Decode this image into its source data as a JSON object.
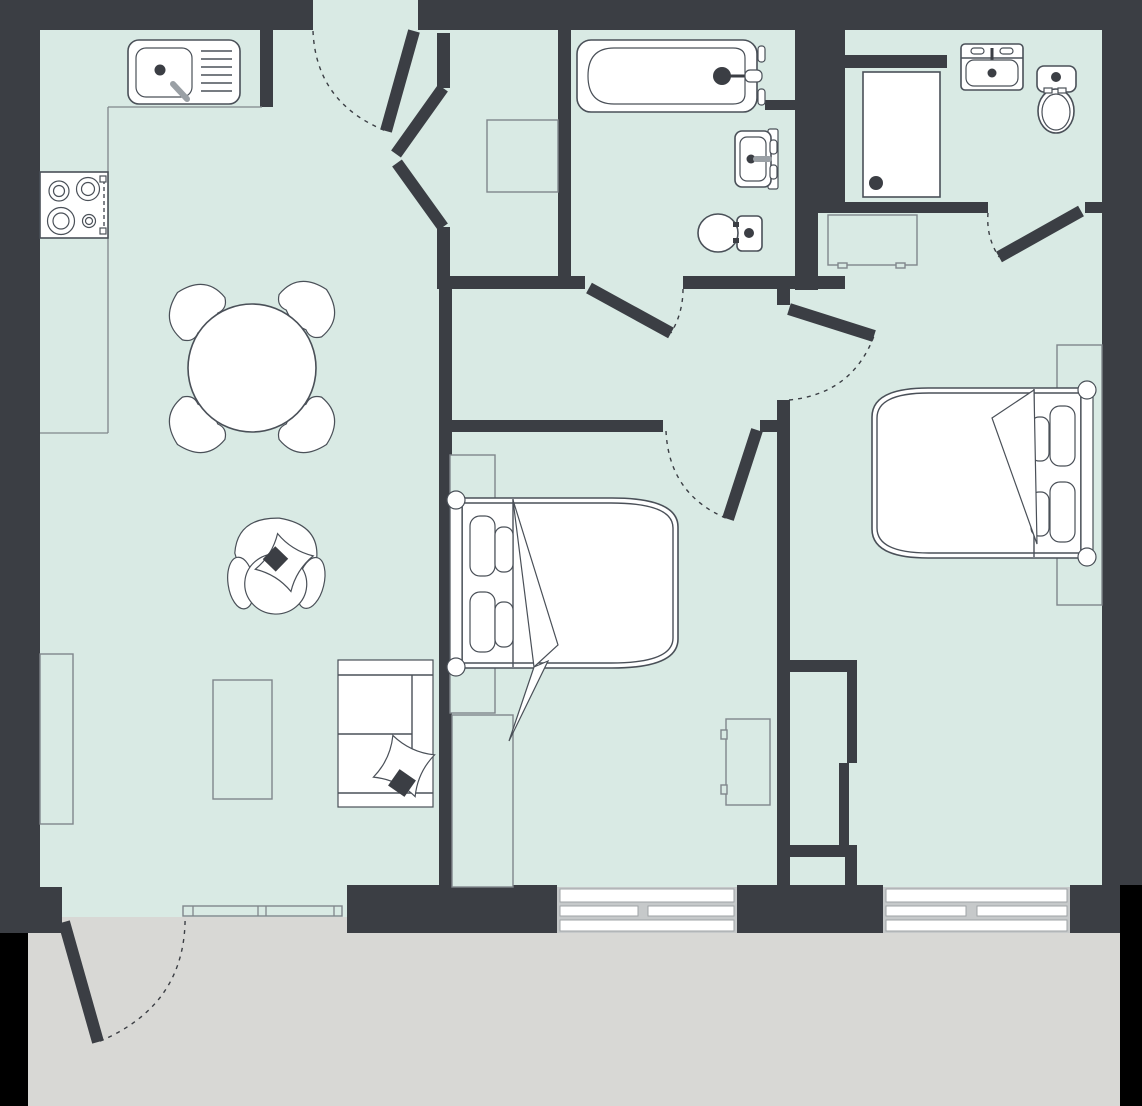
{
  "title": "two-bedroom-apartment-floor-plan",
  "colors": {
    "wall": "#3b3e44",
    "floor": "#d9eae4",
    "balcony": "#d8d8d5",
    "outside": "#000000",
    "white": "#ffffff",
    "fixture_outline": "#4a5058",
    "furniture_outline": "#80868b",
    "faucet_gray": "#9aa0a5",
    "window_frame": "#c6c9ca",
    "accent_dark": "#3b3e44"
  },
  "rooms": [
    {
      "name": "kitchen-living-room",
      "fixtures": [
        "kitchen-sink",
        "stove",
        "counter",
        "dining-table",
        "dining-chairs",
        "armchair",
        "sofa",
        "tv-stand",
        "radiator"
      ]
    },
    {
      "name": "entry-hall",
      "fixtures": [
        "entry-door",
        "vestibule-closet",
        "closet-shelf"
      ]
    },
    {
      "name": "bathroom",
      "fixtures": [
        "bathtub",
        "wall-sink",
        "toilet"
      ]
    },
    {
      "name": "shower-room",
      "fixtures": [
        "shower-tray",
        "vanity-sink",
        "toilet",
        "hall-cabinet"
      ]
    },
    {
      "name": "bedroom-1",
      "fixtures": [
        "double-bed",
        "rug",
        "wardrobe",
        "cabinet"
      ]
    },
    {
      "name": "bedroom-2",
      "fixtures": [
        "double-bed",
        "rug",
        "storage-niche"
      ]
    },
    {
      "name": "balcony",
      "fixtures": [
        "balcony-door",
        "railing"
      ]
    }
  ],
  "doors": [
    "entry-door",
    "bathroom-door",
    "bedroom-1-door",
    "bedroom-2-door",
    "shower-room-door",
    "balcony-door"
  ],
  "windows": [
    "bedroom-1-window",
    "bedroom-2-window"
  ],
  "door_swing_style": "dashed-arc"
}
